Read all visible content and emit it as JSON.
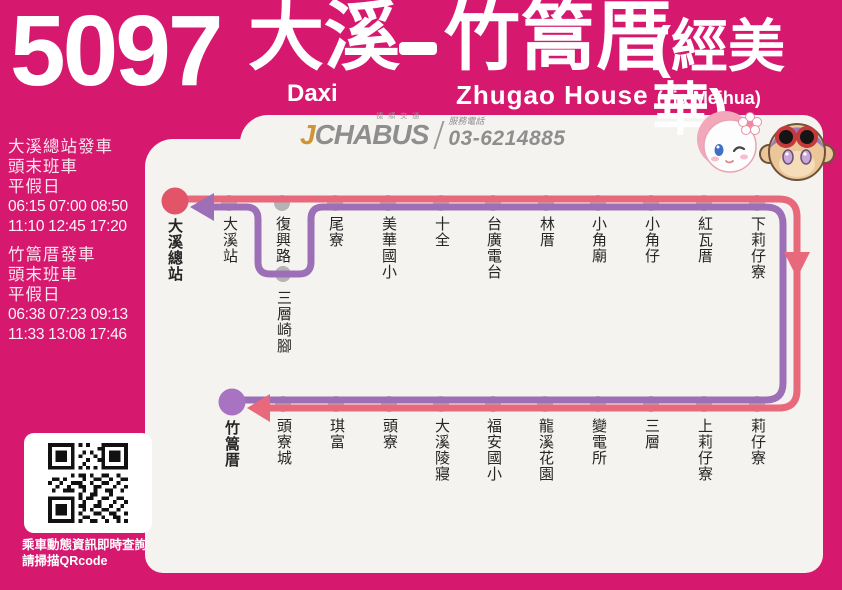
{
  "header": {
    "route_number": "5097",
    "origin_zh": "大溪",
    "destination_zh": "竹篙厝",
    "via_zh": "(經美華)",
    "origin_en": "Daxi",
    "destination_en": "Zhugao House",
    "via_en": "(via Meihua)"
  },
  "brand": {
    "logo_j": "J",
    "logo_cha": "CHA",
    "logo_bus": "BUS",
    "logo_small_text": "捷順交通",
    "service_label": "服務電話",
    "phone": "03-6214885"
  },
  "timetable": {
    "sections": [
      {
        "title": "大溪總站發車",
        "sub1": "頭末班車",
        "sub2": "平假日",
        "times1": "06:15 07:00 08:50",
        "times2": "11:10 12:45 17:20"
      },
      {
        "title": "竹篙厝發車",
        "sub1": "頭末班車",
        "sub2": "平假日",
        "times1": "06:38 07:23 09:13",
        "times2": "11:33 13:08 17:46"
      }
    ]
  },
  "qr": {
    "caption_line1": "乘車動態資訊即時查詢",
    "caption_line2": "請掃描QRcode"
  },
  "route": {
    "origin_terminal": "大溪總站",
    "destination_terminal": "竹篙厝",
    "top_stations": [
      "大溪站",
      "復興路",
      "尾寮",
      "美華國小",
      "十全",
      "台廣電台",
      "林厝",
      "小角廟",
      "小角仔",
      "紅瓦厝",
      "下莉仔寮"
    ],
    "branch_station": "三層崎腳",
    "bottom_stations": [
      "頭寮城",
      "琪富",
      "頭寮",
      "大溪陵寢",
      "福安國小",
      "龍溪花園",
      "變電所",
      "三層",
      "上莉仔寮",
      "莉仔寮"
    ],
    "colors": {
      "outbound_line": "#E8687C",
      "return_line": "#9D6FB6",
      "station_dot": "#B4B3B6",
      "origin_terminal_dot": "#E25568",
      "destination_terminal_dot": "#A873C0",
      "background": "#D6186F",
      "panel": "#F4F3F0"
    }
  }
}
